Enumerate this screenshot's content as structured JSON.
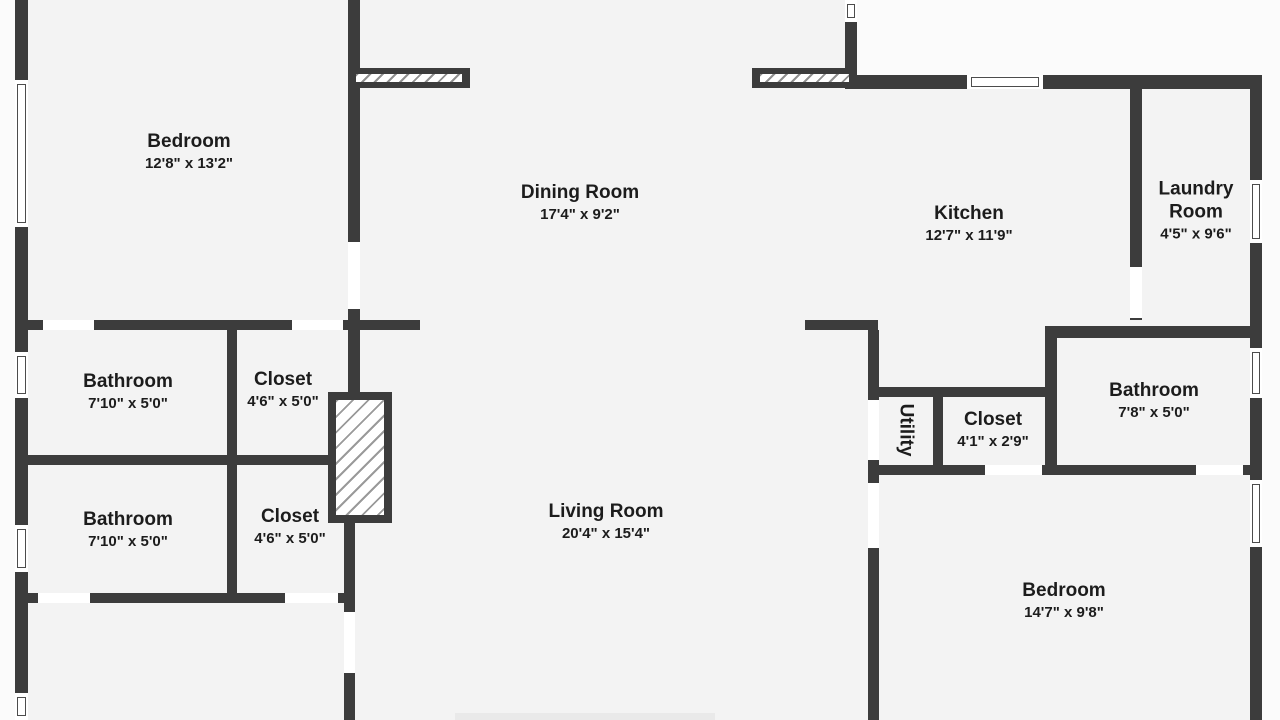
{
  "plan": {
    "canvas": {
      "width": 1280,
      "height": 720
    },
    "colors": {
      "wall": "#3c3c3c",
      "floor": "#f3f3f3",
      "outside": "#fbfbfb",
      "opening": "#ffffff",
      "text": "#1c1c1c"
    },
    "floor_areas": [
      {
        "x": 15,
        "y": 0,
        "w": 345,
        "h": 720
      },
      {
        "x": 348,
        "y": 0,
        "w": 509,
        "h": 720
      },
      {
        "x": 845,
        "y": 75,
        "w": 417,
        "h": 263
      },
      {
        "x": 857,
        "y": 330,
        "w": 405,
        "h": 390
      }
    ],
    "walls": [
      {
        "x": 15,
        "y": 0,
        "w": 13,
        "h": 720
      },
      {
        "x": 348,
        "y": 0,
        "w": 12,
        "h": 330
      },
      {
        "x": 15,
        "y": 320,
        "w": 405,
        "h": 10
      },
      {
        "x": 227,
        "y": 330,
        "w": 10,
        "h": 125
      },
      {
        "x": 15,
        "y": 455,
        "w": 313,
        "h": 10
      },
      {
        "x": 227,
        "y": 465,
        "w": 10,
        "h": 128
      },
      {
        "x": 15,
        "y": 593,
        "w": 340,
        "h": 10
      },
      {
        "x": 348,
        "y": 330,
        "w": 12,
        "h": 62
      },
      {
        "x": 344,
        "y": 523,
        "w": 11,
        "h": 197
      },
      {
        "x": 845,
        "y": 0,
        "w": 12,
        "h": 75
      },
      {
        "x": 845,
        "y": 75,
        "w": 417,
        "h": 14
      },
      {
        "x": 1130,
        "y": 89,
        "w": 12,
        "h": 231
      },
      {
        "x": 1250,
        "y": 75,
        "w": 12,
        "h": 645
      },
      {
        "x": 1045,
        "y": 326,
        "w": 217,
        "h": 12
      },
      {
        "x": 805,
        "y": 320,
        "w": 73,
        "h": 10
      },
      {
        "x": 868,
        "y": 330,
        "w": 11,
        "h": 390
      },
      {
        "x": 868,
        "y": 387,
        "w": 189,
        "h": 10
      },
      {
        "x": 933,
        "y": 397,
        "w": 10,
        "h": 78
      },
      {
        "x": 1045,
        "y": 338,
        "w": 12,
        "h": 137
      },
      {
        "x": 868,
        "y": 465,
        "w": 394,
        "h": 10
      }
    ],
    "door_openings": [
      {
        "x": 43,
        "y": 320,
        "w": 51,
        "h": 10
      },
      {
        "x": 292,
        "y": 320,
        "w": 51,
        "h": 10
      },
      {
        "x": 348,
        "y": 242,
        "w": 12,
        "h": 67
      },
      {
        "x": 38,
        "y": 593,
        "w": 52,
        "h": 10
      },
      {
        "x": 285,
        "y": 593,
        "w": 53,
        "h": 10
      },
      {
        "x": 344,
        "y": 612,
        "w": 11,
        "h": 61
      },
      {
        "x": 1130,
        "y": 267,
        "w": 12,
        "h": 51
      },
      {
        "x": 868,
        "y": 400,
        "w": 11,
        "h": 60
      },
      {
        "x": 868,
        "y": 483,
        "w": 11,
        "h": 65
      },
      {
        "x": 985,
        "y": 465,
        "w": 57,
        "h": 10
      },
      {
        "x": 1196,
        "y": 465,
        "w": 47,
        "h": 10
      }
    ],
    "windows": [
      {
        "x": 15,
        "y": 80,
        "w": 13,
        "h": 147,
        "o": "v"
      },
      {
        "x": 15,
        "y": 352,
        "w": 13,
        "h": 46,
        "o": "v"
      },
      {
        "x": 15,
        "y": 525,
        "w": 13,
        "h": 47,
        "o": "v"
      },
      {
        "x": 15,
        "y": 693,
        "w": 13,
        "h": 27,
        "o": "v"
      },
      {
        "x": 845,
        "y": 0,
        "w": 12,
        "h": 22,
        "o": "v"
      },
      {
        "x": 967,
        "y": 75,
        "w": 76,
        "h": 14,
        "o": "h"
      },
      {
        "x": 1250,
        "y": 180,
        "w": 12,
        "h": 63,
        "o": "v"
      },
      {
        "x": 1250,
        "y": 348,
        "w": 12,
        "h": 50,
        "o": "v"
      },
      {
        "x": 1250,
        "y": 480,
        "w": 12,
        "h": 67,
        "o": "v"
      }
    ],
    "sliding_doors": [
      {
        "x": 348,
        "y": 68,
        "w": 122,
        "h": 20
      },
      {
        "x": 752,
        "y": 68,
        "w": 105,
        "h": 20
      }
    ],
    "fireplace": {
      "x": 328,
      "y": 392,
      "w": 64,
      "h": 131
    },
    "floor_shading": [
      {
        "x": 455,
        "y": 713,
        "w": 260,
        "h": 7
      }
    ],
    "rooms": [
      {
        "name": "Bedroom",
        "dims": "12'8\" x 13'2\"",
        "label_x": 189,
        "label_y": 152
      },
      {
        "name": "Dining Room",
        "dims": "17'4\" x 9'2\"",
        "label_x": 580,
        "label_y": 203
      },
      {
        "name": "Kitchen",
        "dims": "12'7\" x 11'9\"",
        "label_x": 969,
        "label_y": 224
      },
      {
        "name": "Laundry Room",
        "dims": "4'5\" x 9'6\"",
        "label_x": 1196,
        "label_y": 211,
        "wrap": true
      },
      {
        "name": "Bathroom",
        "dims": "7'10\" x 5'0\"",
        "label_x": 128,
        "label_y": 392
      },
      {
        "name": "Closet",
        "dims": "4'6\" x 5'0\"",
        "label_x": 283,
        "label_y": 390
      },
      {
        "name": "Bathroom",
        "dims": "7'10\" x 5'0\"",
        "label_x": 128,
        "label_y": 530
      },
      {
        "name": "Closet",
        "dims": "4'6\" x 5'0\"",
        "label_x": 290,
        "label_y": 527
      },
      {
        "name": "Living Room",
        "dims": "20'4\" x 15'4\"",
        "label_x": 606,
        "label_y": 522
      },
      {
        "name": "Utility",
        "dims": "",
        "label_x": 906,
        "label_y": 430,
        "vertical": true
      },
      {
        "name": "Closet",
        "dims": "4'1\" x 2'9\"",
        "label_x": 993,
        "label_y": 430
      },
      {
        "name": "Bathroom",
        "dims": "7'8\" x 5'0\"",
        "label_x": 1154,
        "label_y": 401
      },
      {
        "name": "Bedroom",
        "dims": "14'7\" x 9'8\"",
        "label_x": 1064,
        "label_y": 601
      }
    ]
  }
}
